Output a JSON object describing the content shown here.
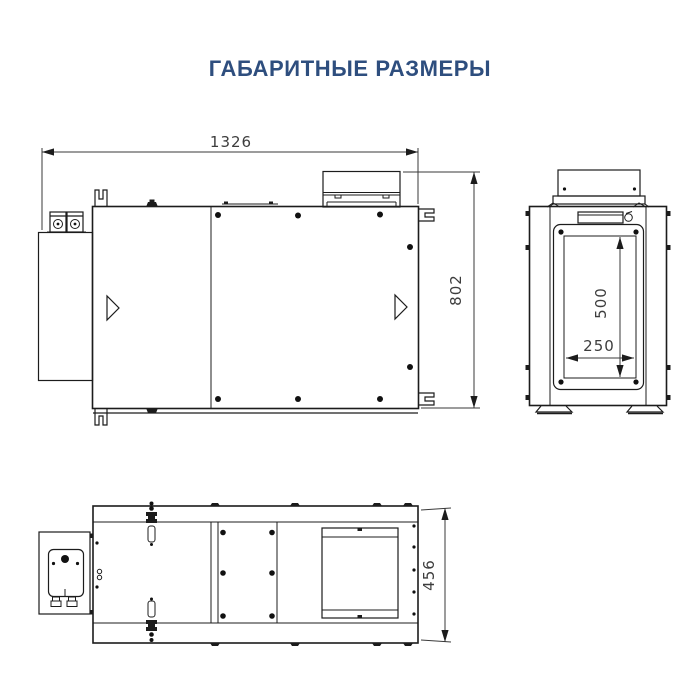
{
  "page": {
    "title": "ГАБАРИТНЫЕ РАЗМЕРЫ",
    "background": "#ffffff"
  },
  "colors": {
    "title_text": "#2e4e7e",
    "drawing_line": "#1c1c1c",
    "dimension_text": "#3d3d3d"
  },
  "drawing": {
    "views": {
      "front": {
        "name": "front view (side elevation)",
        "dimensions": {
          "width": "1326",
          "height": "802"
        }
      },
      "side": {
        "name": "end view with access door",
        "dimensions": {
          "opening_height": "500",
          "opening_width": "250"
        }
      },
      "top": {
        "name": "plan (top) view",
        "dimensions": {
          "depth": "456"
        }
      }
    }
  }
}
